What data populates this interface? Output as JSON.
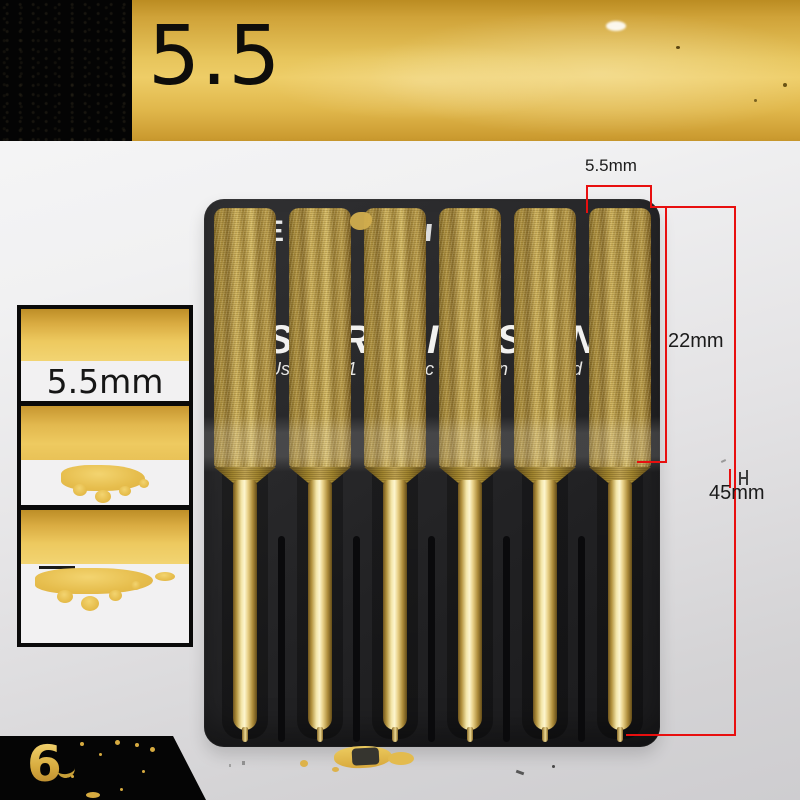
{
  "header": {
    "size": "5.5"
  },
  "thumbnail_panel": {
    "size_label": "5.5mm"
  },
  "dimensions": {
    "diameter": "5.5mm",
    "head_length": "22mm",
    "total_length": "45mm"
  },
  "package_print": {
    "top_fragment": "E",
    "line1": [
      "S",
      "RI",
      "I",
      "S",
      "N"
    ],
    "line2": [
      "Us",
      "1",
      "c",
      "in",
      "d"
    ]
  },
  "badge": {
    "quantity": "6"
  },
  "product": {
    "bit_count": 6
  },
  "colors": {
    "accent_red": "#e80f0f",
    "banner_gold": "#e7c55c",
    "shaft_gold": "#f3e5a8",
    "package_dark": "#232325",
    "badge_black": "#050505"
  }
}
